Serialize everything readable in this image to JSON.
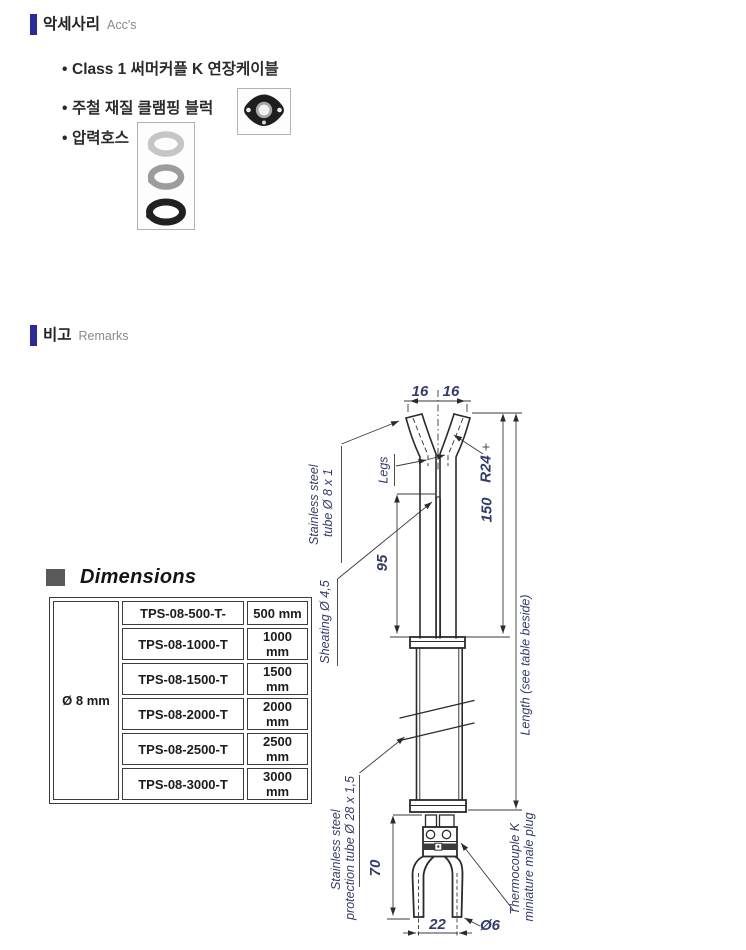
{
  "colors": {
    "accent_bar": "#2a2a9c",
    "dim_text": "#323b6e",
    "line": "#2b2b2b"
  },
  "bullet_glyph": "•",
  "sections": {
    "accessories": {
      "title_ko": "악세사리",
      "title_en": "Acc's",
      "bullets": [
        "Class 1 써머커플 K 연장케이블",
        "주철 재질 클램핑 블럭",
        "압력호스"
      ],
      "images": {
        "clamping_block": "clamping-block-photo",
        "pressure_hose": "pressure-hose-clamps-photo"
      }
    },
    "remarks": {
      "title_ko": "비고",
      "title_en": "Remarks"
    },
    "dimensions": {
      "title": "Dimensions",
      "table": {
        "diameter": "Ø 8 mm",
        "rows": [
          {
            "model": "TPS-08-500-T-",
            "length": "500 mm"
          },
          {
            "model": "TPS-08-1000-T",
            "length": "1000 mm"
          },
          {
            "model": "TPS-08-1500-T",
            "length": "1500 mm"
          },
          {
            "model": "TPS-08-2000-T",
            "length": "2000 mm"
          },
          {
            "model": "TPS-08-2500-T",
            "length": "2500 mm"
          },
          {
            "model": "TPS-08-3000-T",
            "length": "3000 mm"
          }
        ]
      }
    },
    "drawing": {
      "dims": {
        "top_left": "16",
        "top_right": "16",
        "radius": "R24",
        "len150": "150",
        "len95": "95",
        "len70": "70",
        "width22": "22",
        "dia6": "Ø6"
      },
      "labels": {
        "tube1": "Stainless steel",
        "tube2": "tube Ø 8 x 1",
        "legs": "Legs",
        "sheath": "Sheating Ø 4,5",
        "length": "Length (see table beside)",
        "prot1": "Stainless steel",
        "prot2": "protection tube Ø 28 x 1,5",
        "plug1": "Thermocouple K",
        "plug2": "miniature male plug"
      }
    }
  }
}
